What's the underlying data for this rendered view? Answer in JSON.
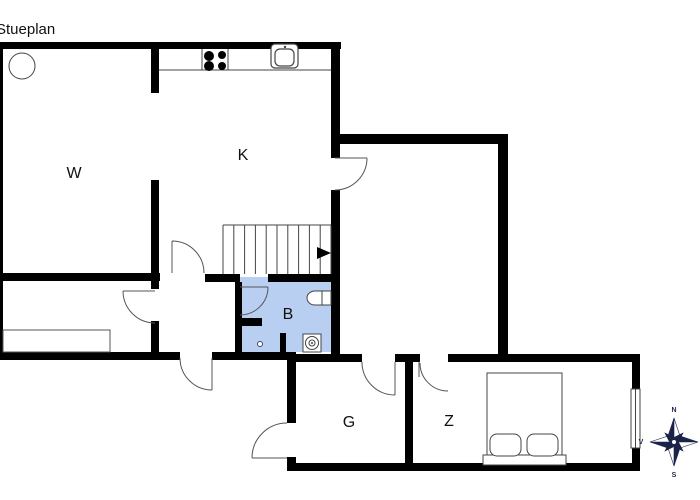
{
  "title": "Stueplan",
  "rooms": {
    "living": {
      "label": "W"
    },
    "kitchen": {
      "label": "K"
    },
    "bath": {
      "label": "B"
    },
    "hall_g": {
      "label": "G"
    },
    "bedroom": {
      "label": "Z"
    }
  },
  "compass": {
    "north": "N",
    "west": "V",
    "south": "S"
  },
  "colors": {
    "wall": "#000000",
    "bathroom_fill": "#b9cff1",
    "compass_navy": "#1b2448"
  }
}
